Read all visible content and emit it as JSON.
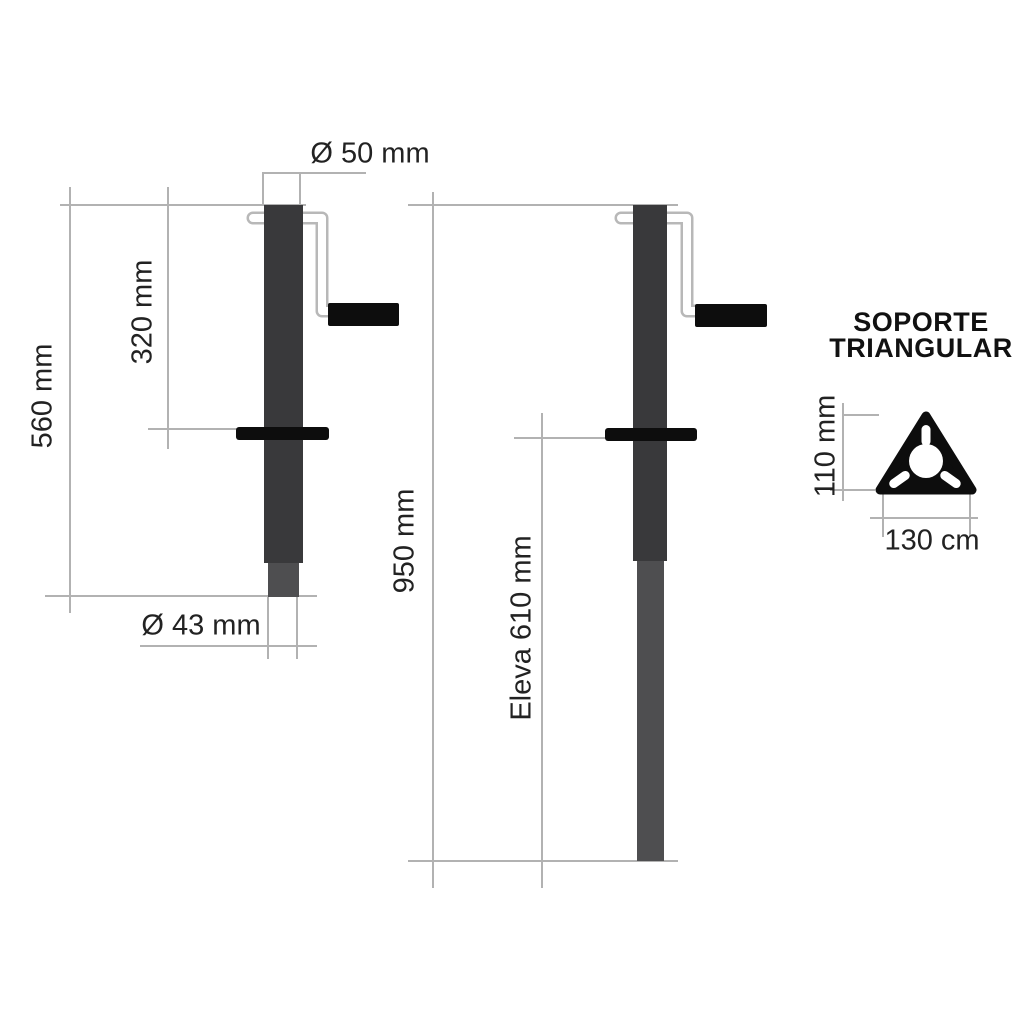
{
  "left_jack": {
    "top_diameter": "Ø 50 mm",
    "total_height": "560 mm",
    "crank_height": "320 mm",
    "inner_diameter": "Ø 43 mm"
  },
  "right_jack": {
    "total_height": "950 mm",
    "lift": "Eleva 610 mm"
  },
  "support": {
    "title_line1": "SOPORTE",
    "title_line2": "TRIANGULAR",
    "height": "110 mm",
    "base_width": "130 cm"
  },
  "colors": {
    "tube_outer": "#39393b",
    "tube_inner": "#4e4e50",
    "solid_black": "#0d0d0d",
    "dimension_line": "#b2b2b2",
    "label_text": "#222222",
    "background": "#ffffff"
  }
}
